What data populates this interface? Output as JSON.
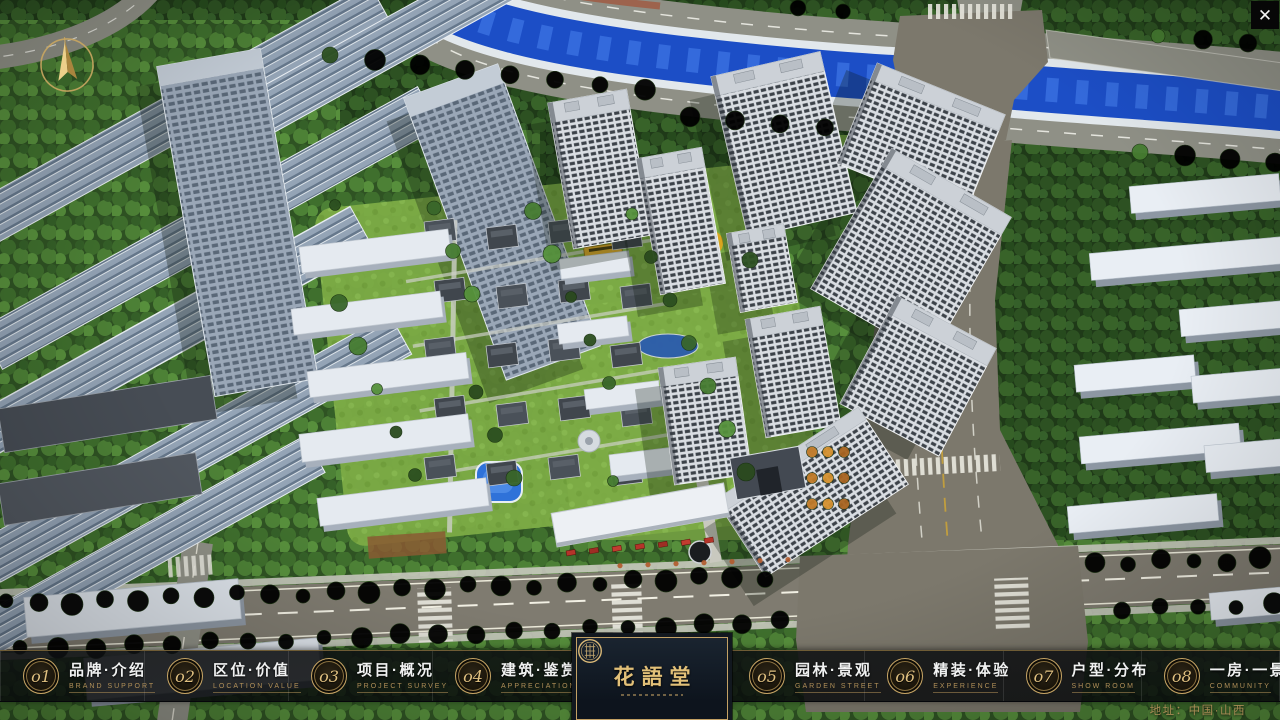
{
  "window": {
    "close_icon": "✕"
  },
  "nav": {
    "items": [
      {
        "num": "o1",
        "title": "品牌·介绍",
        "subtitle": "BRAND SUPPORT"
      },
      {
        "num": "o2",
        "title": "区位·价值",
        "subtitle": "LOCATION VALUE"
      },
      {
        "num": "o3",
        "title": "项目·概况",
        "subtitle": "PROJECT SURVEY"
      },
      {
        "num": "o4",
        "title": "建筑·鉴赏",
        "subtitle": "APPRECIATION"
      },
      {
        "num": "o5",
        "title": "园林·景观",
        "subtitle": "GARDEN STREET"
      },
      {
        "num": "o6",
        "title": "精装·体验",
        "subtitle": "EXPERIENCE"
      },
      {
        "num": "o7",
        "title": "户型·分布",
        "subtitle": "SHOW ROOM"
      },
      {
        "num": "o8",
        "title": "一房·一景",
        "subtitle": "COMMUNITY"
      }
    ]
  },
  "logo": {
    "name": "花語堂"
  },
  "footer": {
    "address": "地址：中国·山西"
  },
  "colors": {
    "accent_gold": "#c9a660",
    "nav_background": "#0a0c0e",
    "river_blue": "#1c4ec6"
  }
}
